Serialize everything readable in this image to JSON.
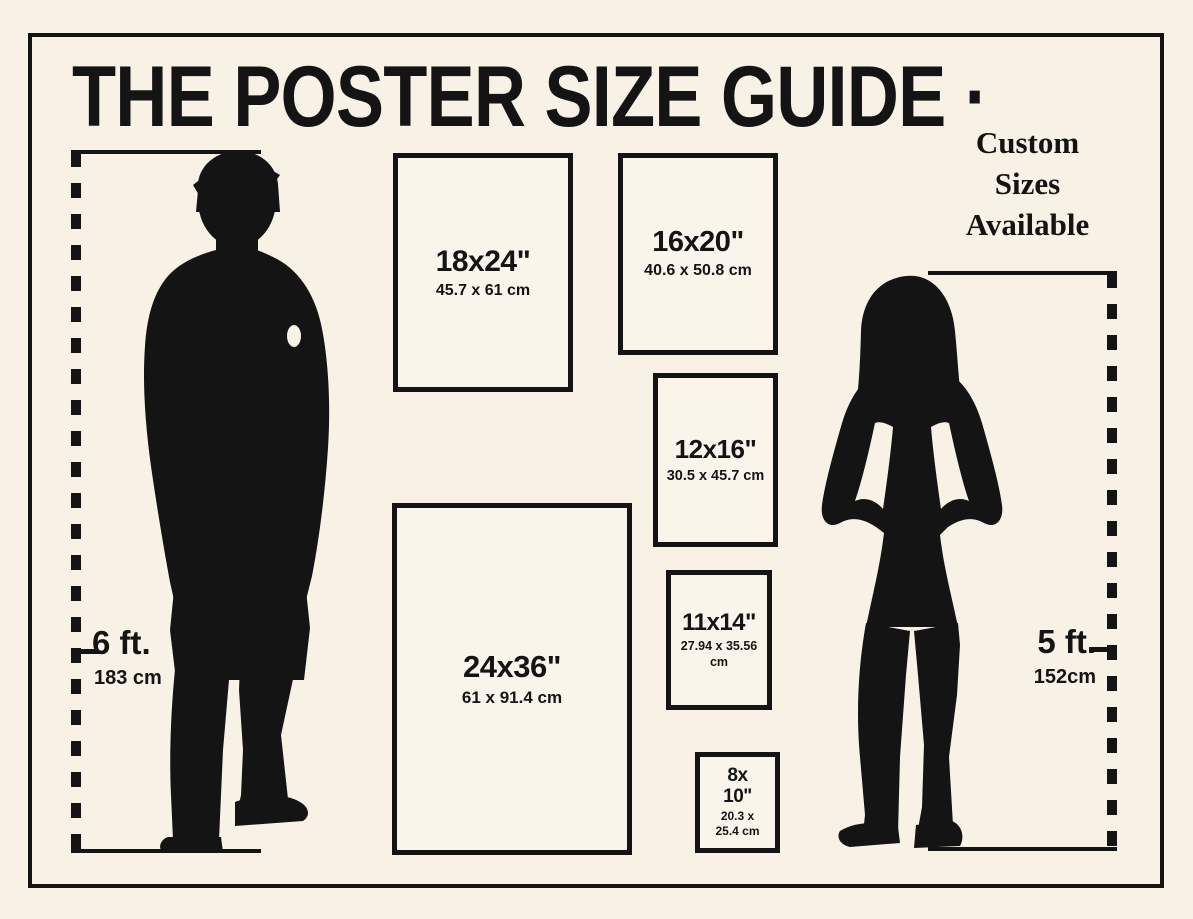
{
  "title": "THE POSTER SIZE GUIDE ·",
  "custom_note": {
    "lines": [
      "Custom",
      "Sizes",
      "Available"
    ]
  },
  "measures": {
    "male": {
      "feet": "6 ft.",
      "cm": "183 cm"
    },
    "female": {
      "feet": "5 ft.",
      "cm": "152cm"
    }
  },
  "posters": [
    {
      "inches": "18x24\"",
      "cm": "45.7 x 61 cm"
    },
    {
      "inches": "16x20\"",
      "cm": "40.6 x 50.8 cm"
    },
    {
      "inches": "12x16\"",
      "cm": "30.5 x 45.7 cm"
    },
    {
      "inches": "11x14\"",
      "cm": "27.94 x 35.56 cm"
    },
    {
      "inches": "24x36\"",
      "cm": "61 x 91.4 cm"
    },
    {
      "inches_line1": "8x",
      "inches_line2": "10\"",
      "cm_line1": "20.3 x",
      "cm_line2": "25.4 cm"
    }
  ],
  "figures": {
    "male": "man-silhouette-icon",
    "female": "woman-silhouette-icon"
  },
  "colors": {
    "background": "#f7f2e5",
    "ink": "#141414",
    "box_fill": "#f9f5eb"
  }
}
